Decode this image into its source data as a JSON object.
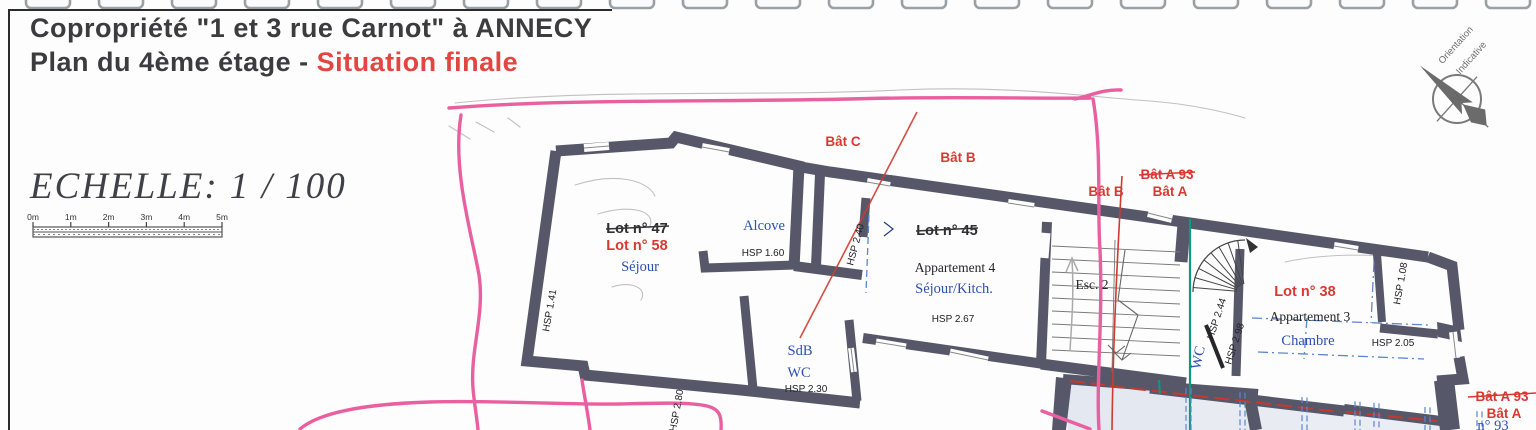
{
  "header": {
    "title_line1": "Copropriété \"1 et 3 rue Carnot\" à ANNECY",
    "title_line2_prefix": "Plan du 4ème étage - ",
    "title_line2_emphasis": "Situation finale"
  },
  "scale": {
    "label": "ECHELLE: 1 / 100",
    "ticks": [
      "0m",
      "1m",
      "2m",
      "3m",
      "4m",
      "5m"
    ]
  },
  "compass": {
    "north_letter": "N",
    "caption_line1": "Orientation",
    "caption_line2": "Indicative"
  },
  "colors": {
    "wall": "#57576a",
    "red_label": "#d93832",
    "blue_label": "#2c50b0",
    "pink_marker": "#e960a0",
    "teal_line": "#0a9c7d",
    "red_line": "#cf3a31",
    "blue_dash": "#5b86cf"
  },
  "building_labels": {
    "bat_c": "Bât C",
    "bat_b_top": "Bât B",
    "bat_b_mid": "Bât B",
    "bat_a93_mid": "Bât A 93",
    "bat_a_mid": "Bât A",
    "bat_a93_bottom": "Bât A 93",
    "bat_a_bottom": "Bât A",
    "n93": "n° 93"
  },
  "apartment_left": {
    "lot_old": "Lot n° 47",
    "lot_new": "Lot n° 58",
    "room": "Séjour",
    "alcove": "Alcove",
    "alcove_hsp": "HSP 1.60",
    "hsp_left_wall": "HSP 1.41",
    "hsp_bottom": "HSP 2.80",
    "bath": "SdB",
    "wc": "WC",
    "bath_hsp": "HSP 2.30"
  },
  "apartment_middle": {
    "lot_old": "Lot n° 45",
    "name": "Appartement 4",
    "room": "Séjour/Kitch.",
    "hsp": "HSP 2.67",
    "hsp_left": "HSP 2.40",
    "stairs": "Esc. 2"
  },
  "apartment_right": {
    "lot": "Lot n° 38",
    "name": "Appartement 3",
    "room": "Chambre",
    "hsp": "HSP 2.05",
    "hsp_closet": "HSP 1.08",
    "wc": "WC",
    "hsp_wc1": "HSP 2.44",
    "hsp_wc2": "HSP 2.98"
  }
}
